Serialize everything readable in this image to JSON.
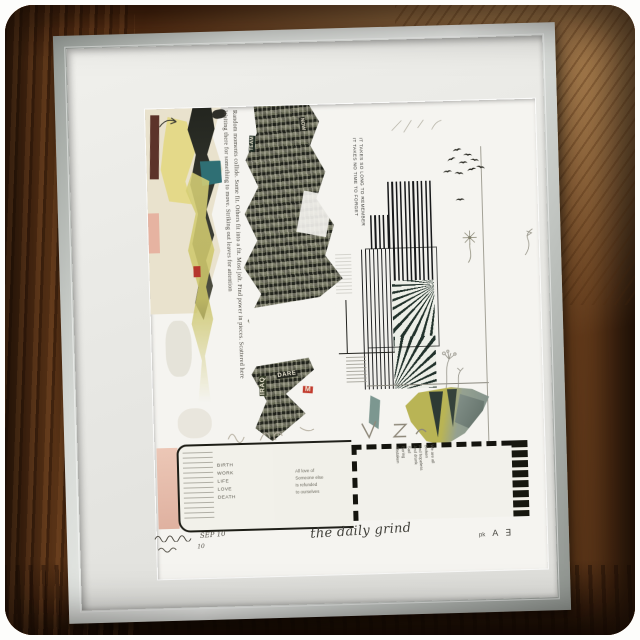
{
  "photo": {
    "subject": "framed mixed-media collage print photographed on a wood background",
    "frame_color": "#d8dbd7",
    "mat_color": "#e9e9e5",
    "paper_color": "#f5f4f0",
    "wood_color": "#7c4a22"
  },
  "print": {
    "title_script": "the daily grind",
    "edition": {
      "line1": "SEP 10",
      "line2": "10"
    },
    "monogram": {
      "small": "pk",
      "a": "A",
      "e": "∃"
    },
    "margin_lines": [
      "Random moments collide.  Some fit.  Others fit into a fit.  Most jolt.  Find power in pieces.  Scattered here",
      "Waiting there for something to move.  Striking out leaves for attention"
    ],
    "memory_lines": [
      "IT TAKES SO LONG TO REMEMBER",
      "IT TAKES NO TIME TO FORGET"
    ],
    "clippings": [
      "TEAM",
      "NOW",
      "DARE",
      "IRAQ",
      "M"
    ],
    "stamps": {
      "life_list": [
        "BIRTH",
        "WORK",
        "LIFE",
        "LOVE",
        "DEATH"
      ],
      "love_note": [
        "All love of",
        "Someone else",
        "is refunded",
        "to ourselves"
      ],
      "we_are": [
        "We are all",
        "Broken",
        "And hopeless",
        "And drunk",
        "Sad",
        "Boring",
        "Mistaken"
      ]
    }
  }
}
